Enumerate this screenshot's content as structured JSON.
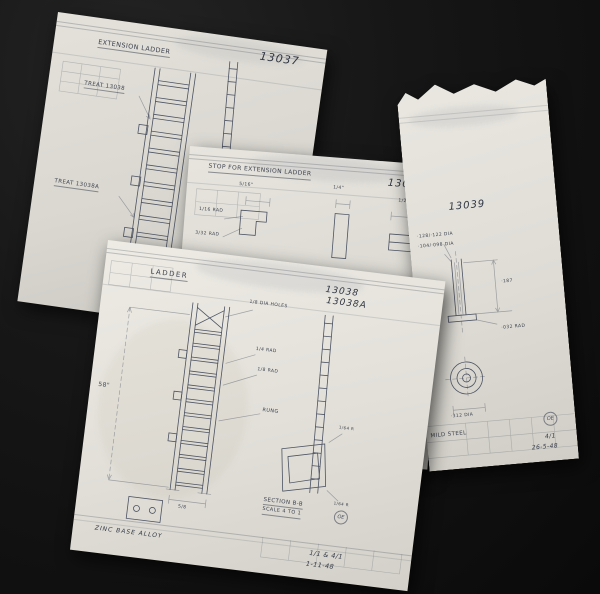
{
  "photo": {
    "background": "#111111",
    "paper": "#e2e0d9",
    "ink": "#4d5363"
  },
  "sheets": {
    "s13037": {
      "title": "EXTENSION LADDER",
      "number": "13037",
      "callout_upper": "TREAT 13038",
      "callout_lower": "TREAT 13038A"
    },
    "s13040": {
      "title": "STOP FOR EXTENSION LADDER",
      "number": "13040",
      "dims": {
        "top_left": "5/16\"",
        "top_mid": "1/4\"",
        "top_right": "1/2\"",
        "side_right": "3/8\"",
        "rad_a": "1/16 RAD",
        "rad_b": "3/32 RAD",
        "width_a": "·309",
        "width_b": "·307",
        "rad_c": "·175 RAD",
        "rad_d": "15 RAD",
        "rad_e": "1/8 RAD"
      },
      "section_label": "SECTION A-A",
      "section_scale": "SCALE 4 TO 1",
      "card": {
        "scale_label": "SCALE",
        "scale_value": "4/1",
        "date_label": "DATE",
        "date_value": "27-5-48",
        "stamp": "OE"
      }
    },
    "s13039": {
      "number": "13039",
      "dims": {
        "dia_a": "·128/·122 DIA",
        "dia_b": "·104/·098 DIA",
        "len": "·187",
        "rad": "·032 RAD",
        "dia_c": "·312 DIA"
      },
      "material": "MILD STEEL",
      "stamp": "OE",
      "scale_note": "4/1",
      "date": "26-5-48"
    },
    "s13038": {
      "title": "LADDER",
      "number_top": "13038",
      "number_bottom": "13038A",
      "dims": {
        "length": "58\"",
        "holes": "1/8 DIA HOLES",
        "rad_a": "1/4 RAD",
        "rad_b": "1/8 RAD",
        "rung": "RUNG",
        "width": "5/8",
        "rad_c": "1/64 R",
        "rad_d": "1/64 R"
      },
      "section_label": "SECTION B-B",
      "section_scale": "SCALE 4 TO 1",
      "material": "ZINC BASE ALLOY",
      "stamp": "OE",
      "scale_note": "1/1 & 4/1",
      "date": "1-11-48"
    }
  }
}
